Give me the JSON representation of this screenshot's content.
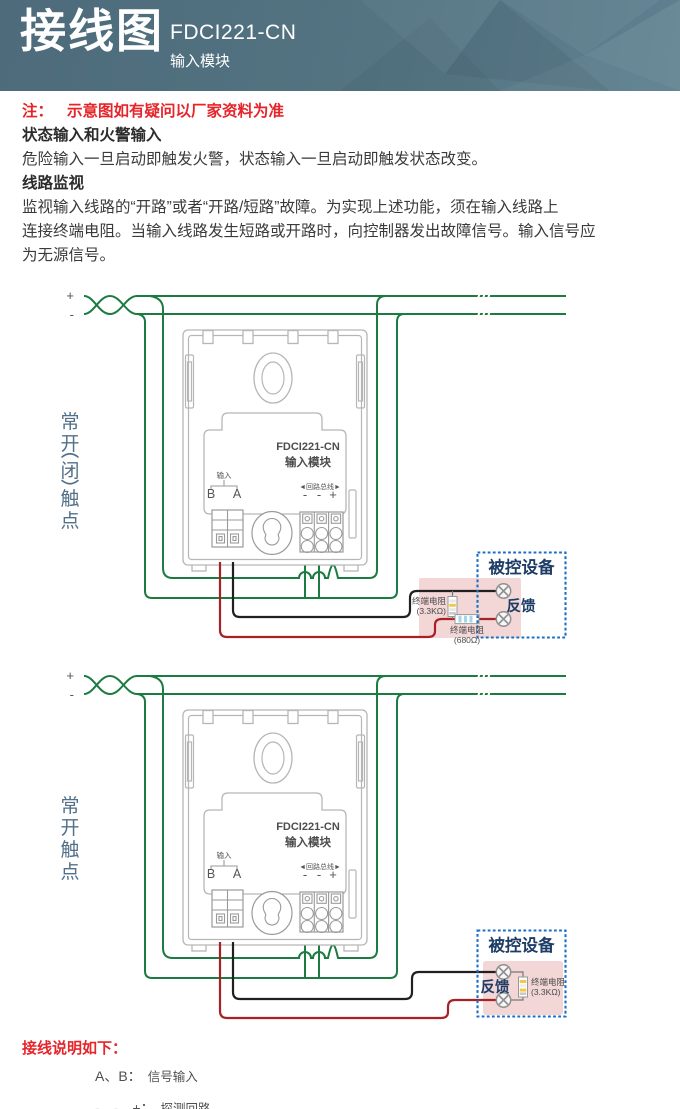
{
  "header": {
    "title": "接线图",
    "model": "FDCI221-CN",
    "subtitle": "输入模块"
  },
  "note": {
    "label": "注：",
    "text": "示意图如有疑问以厂家资料为准"
  },
  "sections": [
    {
      "heading": "状态输入和火警输入",
      "lines": [
        "危险输入一旦启动即触发火警，状态输入一旦启动即触发状态改变。"
      ]
    },
    {
      "heading": "线路监视",
      "lines": [
        "监视输入线路的“开路”或者“开路/短路”故障。为实现上述功能，须在输入线路上",
        "连接终端电阻。当输入线路发生短路或开路时，向控制器发出故障信号。输入信号应",
        "为无源信号。"
      ]
    }
  ],
  "module": {
    "model": "FDCI221-CN",
    "name": "输入模块",
    "input_group_label": "输入",
    "terminal_b": "B",
    "terminal_a": "A",
    "bus_label": "◄回路总线►",
    "bus_terminals": [
      "-",
      "-",
      "+"
    ]
  },
  "diagram1": {
    "contact_label": "常开(闭)触点",
    "contact_chars": [
      "常",
      "开",
      "闭",
      "触",
      "点"
    ],
    "wire_plus": "+",
    "wire_minus": "-",
    "device": {
      "title": "被控设备",
      "feedback_label": "反馈",
      "eol_resistor_label": "终端电阻",
      "eol_resistor_value": "(3.3KΩ)",
      "series_resistor_label": "终端电阻",
      "series_resistor_value": "(680Ω)"
    }
  },
  "diagram2": {
    "contact_label": "常开触点",
    "contact_chars": [
      "常",
      "开",
      "触",
      "点"
    ],
    "wire_plus": "+",
    "wire_minus": "-",
    "device": {
      "title": "被控设备",
      "feedback_label": "反馈",
      "eol_resistor_label": "终端电阻",
      "eol_resistor_value": "(3.3KΩ)"
    }
  },
  "footer": {
    "heading": "接线说明如下：",
    "lines": [
      {
        "term": "A、B：",
        "desc": "信号输入"
      },
      {
        "term": "-、-、+：",
        "desc": "探测回路"
      }
    ]
  },
  "colors": {
    "banner_bg": "#4d6b7b",
    "loop_wire_green": "#1b7b41",
    "signal_wire_black": "#231f20",
    "signal_wire_red": "#a72126",
    "device_box_border": "#1a6fc4",
    "device_fill_pink": "#f3d6d6",
    "accent_red": "#e6252b",
    "contact_label_blue": "#527089",
    "device_text_navy": "#1d3c66"
  }
}
